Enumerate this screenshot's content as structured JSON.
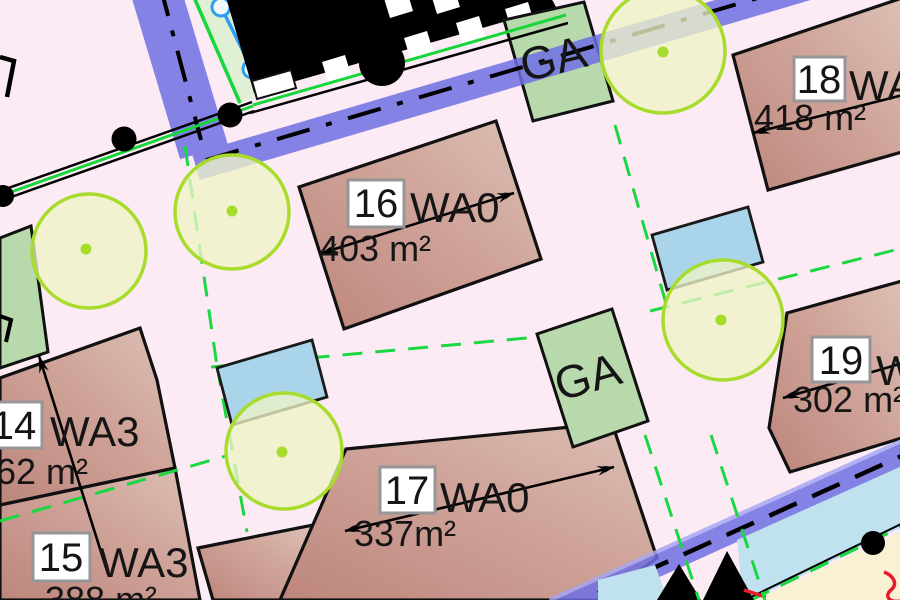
{
  "map": {
    "parcels": [
      {
        "number": "14",
        "zone": "WA3",
        "area": "62 m²"
      },
      {
        "number": "15",
        "zone": "WA3",
        "area": "388 m²"
      },
      {
        "number": "16",
        "zone": "WA0",
        "area": "403 m²"
      },
      {
        "number": "17",
        "zone": "WA0",
        "area": "337m²"
      },
      {
        "number": "18",
        "zone": "WA",
        "area": "418 m²"
      },
      {
        "number": "19",
        "zone": "W",
        "area": "302 m²"
      }
    ],
    "area_labels": [
      {
        "label": "GA"
      },
      {
        "label": "GA"
      }
    ],
    "colors": {
      "background": "#fcebf4",
      "parcel_fill": "#cfa399",
      "road_blue": "#6f6fe4",
      "green_area": "#b7d9ac",
      "water_blue": "#a9d4e9",
      "tree_green": "#a8dc2c",
      "boundary_green": "#1bd741",
      "utility_cyan": "#2e9df0",
      "highlight_red": "#e8192c",
      "building_black": "#000000",
      "cream_area": "#faf0d2"
    }
  }
}
